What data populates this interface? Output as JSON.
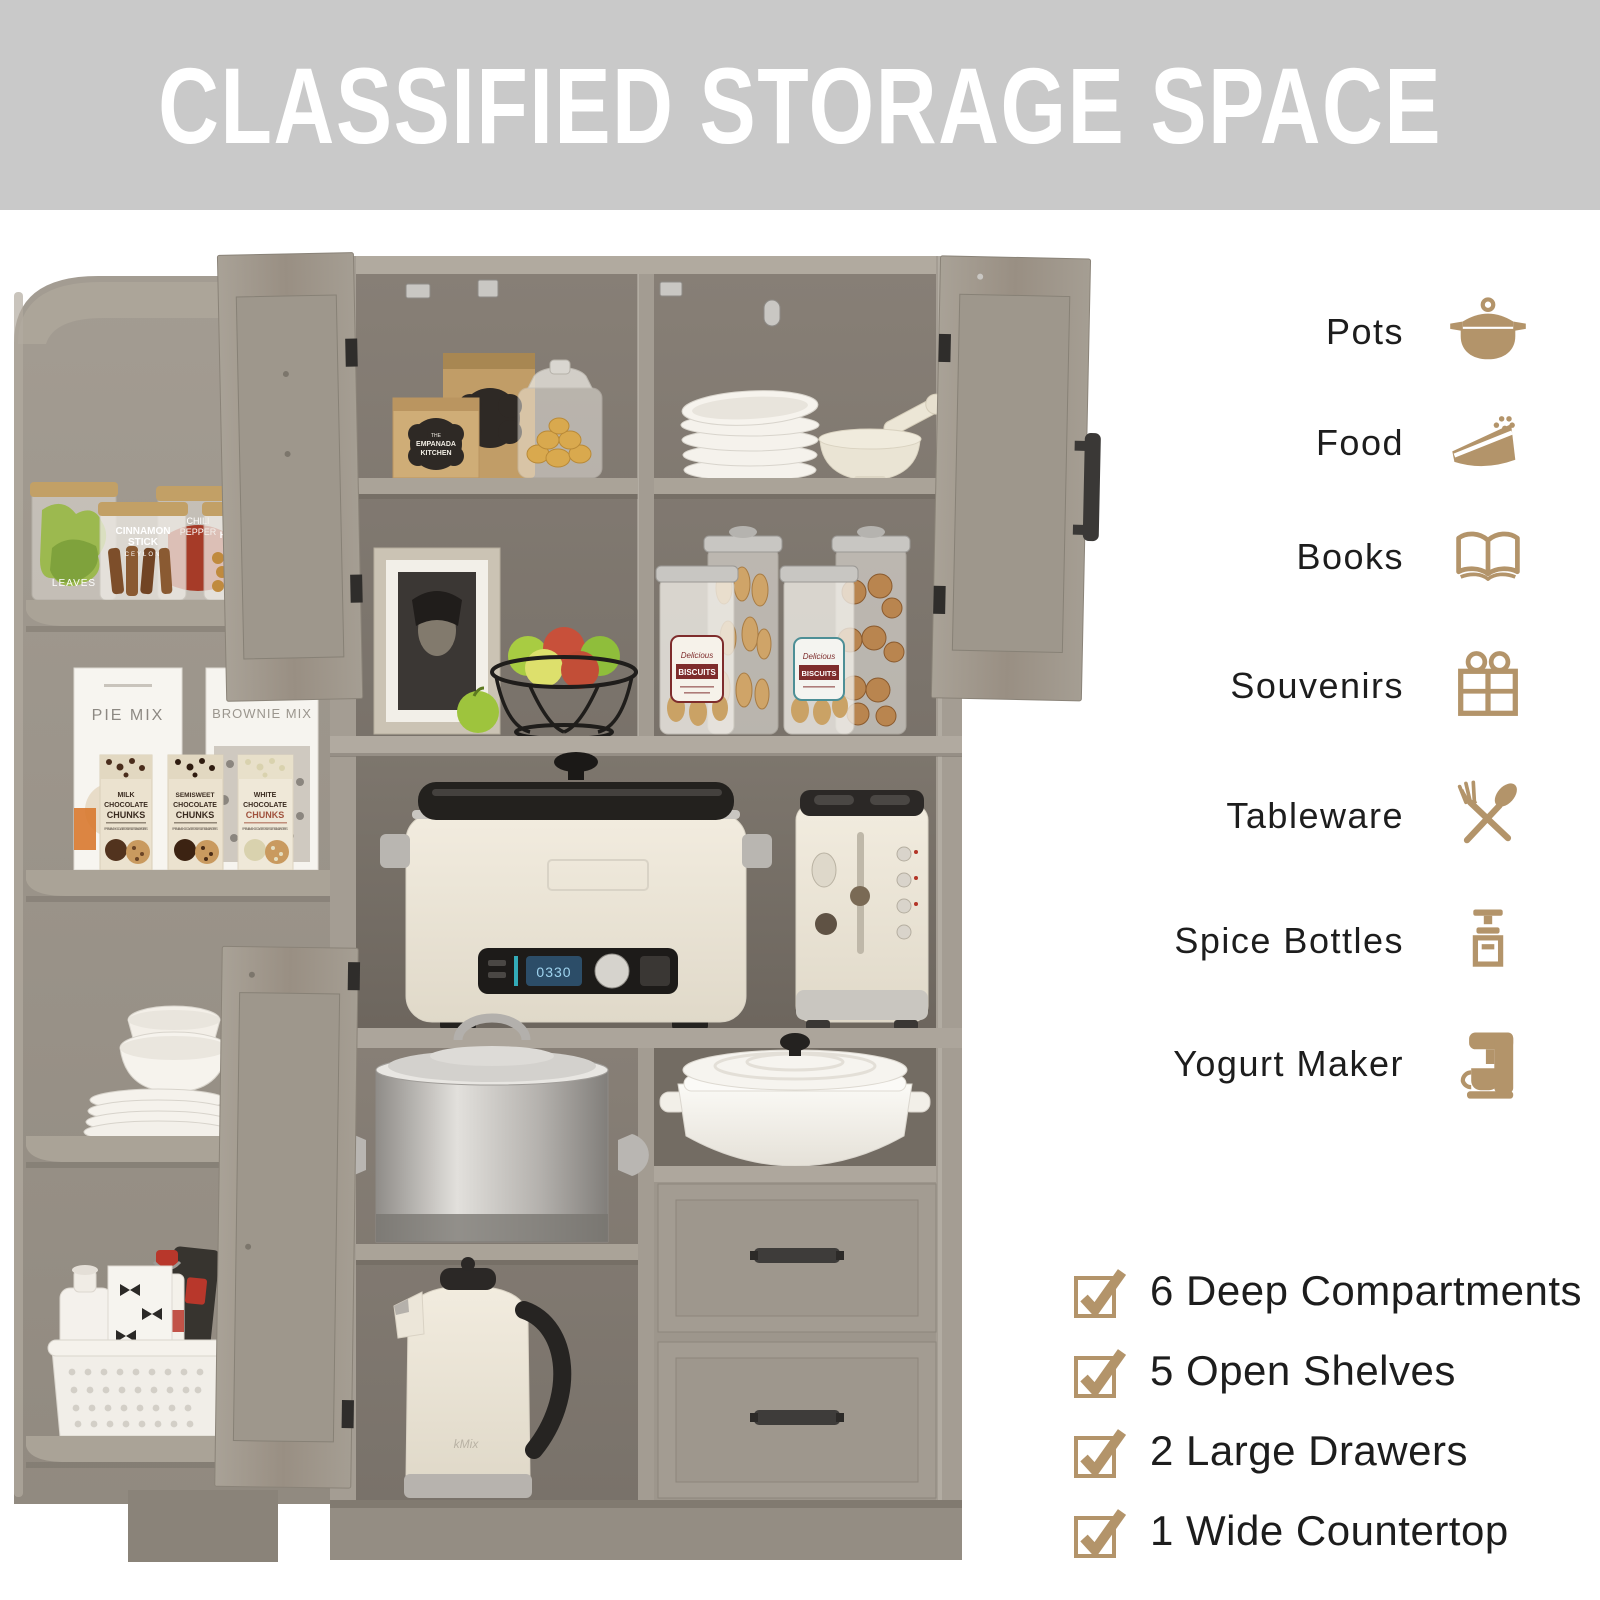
{
  "header": {
    "title": "CLASSIFIED STORAGE SPACE"
  },
  "colors": {
    "banner_bg": "#c9c9c9",
    "banner_text": "#ffffff",
    "accent_gold": "#b3946a",
    "label_text": "#1d1d1d",
    "cabinet_wood": "#9d968c",
    "cabinet_interior": "#7b746b"
  },
  "categories": {
    "items": [
      {
        "label": "Pots",
        "icon": "pot-icon"
      },
      {
        "label": "Food",
        "icon": "cake-slice-icon"
      },
      {
        "label": "Books",
        "icon": "open-book-icon"
      },
      {
        "label": "Souvenirs",
        "icon": "gift-box-icon"
      },
      {
        "label": "Tableware",
        "icon": "fork-spoon-icon"
      },
      {
        "label": "Spice Bottles",
        "icon": "spice-grinder-icon"
      },
      {
        "label": "Yogurt Maker",
        "icon": "yogurt-maker-icon"
      }
    ]
  },
  "features": {
    "items": [
      {
        "text": "6 Deep Compartments"
      },
      {
        "text": "5 Open Shelves"
      },
      {
        "text": "2 Large Drawers"
      },
      {
        "text": "1 Wide Countertop"
      }
    ]
  },
  "photo": {
    "jars": [
      {
        "lines": [
          "LEAVES"
        ]
      },
      {
        "lines": [
          "CINNAMON",
          "STICK",
          "CEYLON"
        ]
      },
      {
        "lines": [
          "CHILI",
          "PEPPER"
        ]
      },
      {
        "lines": [
          "HAZELNUT"
        ]
      }
    ],
    "mix_boxes": [
      "PIE MIX",
      "BROWNIE MIX"
    ],
    "chunk_boxes": [
      {
        "l1": "MILK",
        "l2": "CHOCOLATE",
        "l3": "CHUNKS"
      },
      {
        "l1": "SEMISWEET",
        "l2": "CHOCOLATE",
        "l3": "CHUNKS"
      },
      {
        "l1": "WHITE",
        "l2": "CHOCOLATE",
        "l3": "CHUNKS"
      }
    ],
    "chunk_tagline": "PREMIUM CHOCOLATE FOR DESSERTS AND PASTRIES",
    "bag_brand": {
      "l1": "THE",
      "l2": "EMPANADA",
      "l3": "KITCHEN"
    },
    "biscuit_script": "Delicious",
    "biscuit_label": "BISCUITS",
    "kettle_brand": "kMix",
    "cooker_display": "0330"
  }
}
